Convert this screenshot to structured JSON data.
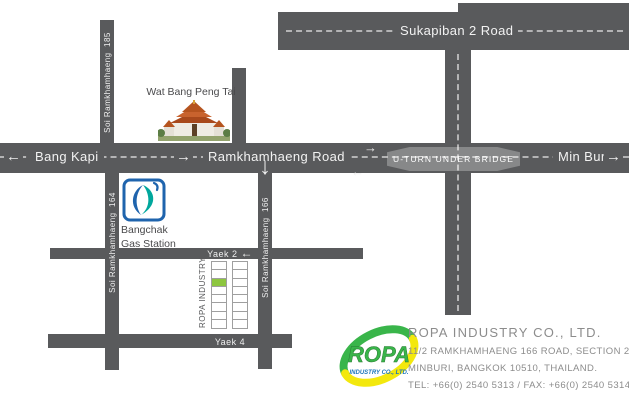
{
  "colors": {
    "road_gray": "#595a5c",
    "plot_green": "#8dc63f",
    "bangchak_blue": "#1f64ad",
    "bangchak_teal": "#00a79d",
    "ropa_green": "#39b54a",
    "ropa_yellow": "#f3e80d",
    "ropa_blue": "#1b75bb"
  },
  "roads": {
    "sukapiban_2": "Sukapiban 2 Road",
    "soi_ramkhamhaeng_185": "Soi Ramkhamhaeng  185",
    "soi_ramkhamhaeng_164": "Soi Ramkhamhaeng  164",
    "soi_ramkhamhaeng_166": "Soi Ramkhamhaeng  166",
    "bang_kapi": "Bang Kapi",
    "ramkhamhaeng_road": "Ramkhamhaeng Road",
    "min_buri": "Min Buri",
    "u_turn": "U-TURN UNDER BRIDGE",
    "yaek_2": "Yaek 2",
    "yaek_4": "Yaek 4"
  },
  "landmarks": {
    "temple_name": "Wat Bang Peng Tai",
    "gas_station_line1": "Bangchak",
    "gas_station_line2": "Gas Station",
    "plots_label": "ROPA INDUSTRY"
  },
  "company": {
    "logo_word": "ROPA",
    "logo_tagline": "INDUSTRY CO., LTD.",
    "name": "ROPA INDUSTRY CO., LTD.",
    "address_line1": "11/2 RAMKHAMHAENG 166 ROAD, SECTION 2",
    "address_line2": "MINBURI, BANGKOK 10510, THAILAND.",
    "contact": "TEL: +66(0) 2540 5313 / FAX: +66(0) 2540 5314"
  },
  "icons": {
    "arrow_left": "←",
    "arrow_right": "→",
    "arrow_down": "↓"
  }
}
